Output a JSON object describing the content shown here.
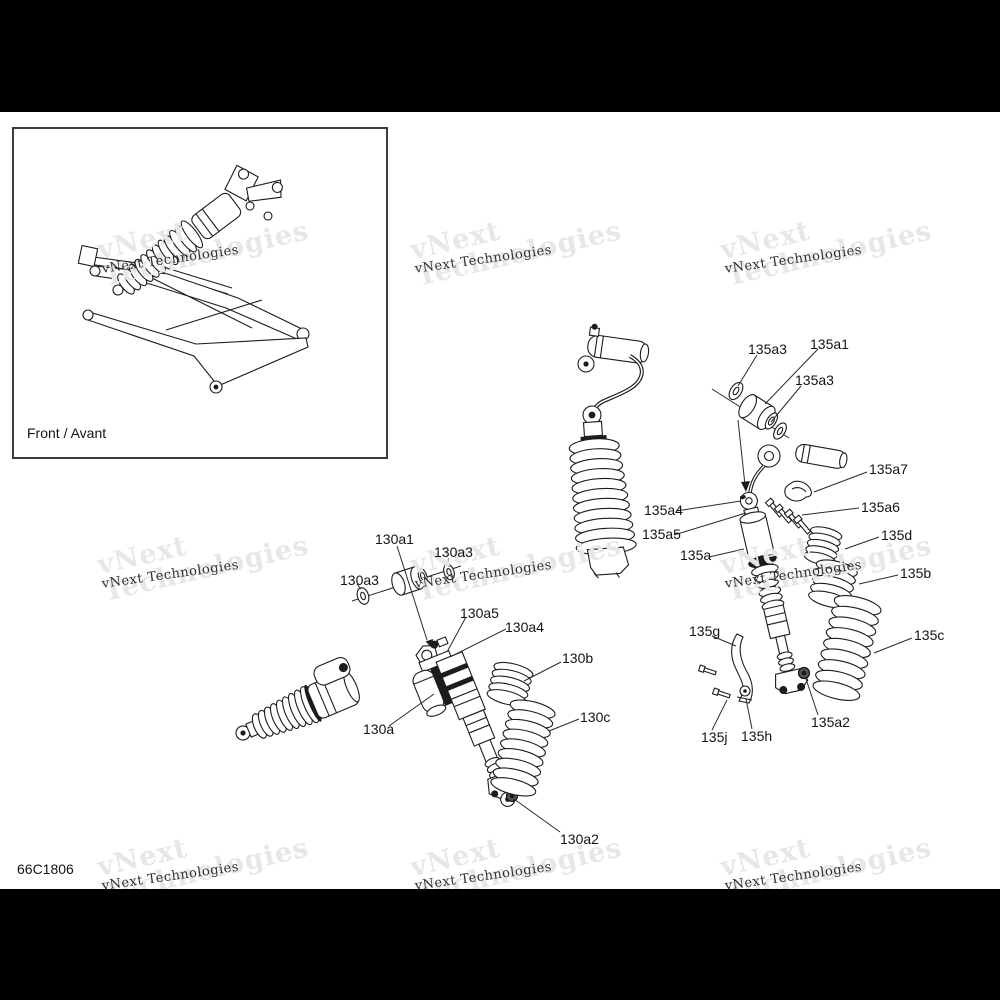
{
  "document": {
    "part_code": "66C1806",
    "inset_caption": "Front / Avant"
  },
  "watermark": {
    "line1": "vNext",
    "line2": "Technologies",
    "small": "vNext Technologies"
  },
  "callouts": [
    {
      "id": "130a1",
      "text": "130a1"
    },
    {
      "id": "130a3-right",
      "text": "130a3"
    },
    {
      "id": "130a3-left",
      "text": "130a3"
    },
    {
      "id": "130a5",
      "text": "130a5"
    },
    {
      "id": "130a4",
      "text": "130a4"
    },
    {
      "id": "130b",
      "text": "130b"
    },
    {
      "id": "130c",
      "text": "130c"
    },
    {
      "id": "130a",
      "text": "130a"
    },
    {
      "id": "130a2",
      "text": "130a2"
    },
    {
      "id": "135a3-upper",
      "text": "135a3"
    },
    {
      "id": "135a1",
      "text": "135a1"
    },
    {
      "id": "135a3-lower",
      "text": "135a3"
    },
    {
      "id": "135a7",
      "text": "135a7"
    },
    {
      "id": "135a6",
      "text": "135a6"
    },
    {
      "id": "135d",
      "text": "135d"
    },
    {
      "id": "135b",
      "text": "135b"
    },
    {
      "id": "135c",
      "text": "135c"
    },
    {
      "id": "135a4",
      "text": "135a4"
    },
    {
      "id": "135a5",
      "text": "135a5"
    },
    {
      "id": "135a",
      "text": "135a"
    },
    {
      "id": "135g",
      "text": "135g"
    },
    {
      "id": "135j",
      "text": "135j"
    },
    {
      "id": "135h",
      "text": "135h"
    },
    {
      "id": "135a2",
      "text": "135a2"
    }
  ]
}
